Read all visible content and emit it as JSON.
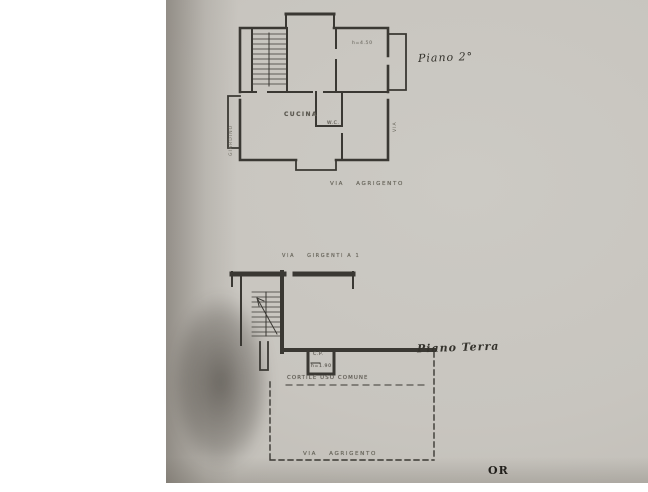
{
  "photo": {
    "paper_color": "#c8c5bf",
    "corner_mark": "OR"
  },
  "piano2": {
    "handwritten_label": "Piano 2°",
    "room_labels": {
      "kitchen": "CUCINA",
      "wc": "W.C.",
      "height_note": "h=4.50"
    },
    "side_label_left": "GIARDINO",
    "side_label_right": "VIA",
    "street_bottom": {
      "prefix": "VIA",
      "name": "AGRIGENTO"
    }
  },
  "piano_terra": {
    "handwritten_label": "Piano Terra",
    "street_top": {
      "prefix": "VIA",
      "name": "GIRGENTI A 1"
    },
    "small_room": {
      "line1": "C.P.",
      "line2": "h=1.90"
    },
    "courtyard_label": "CORTILE USO COMUNE",
    "street_bottom": {
      "prefix": "VIA",
      "name": "AGRIGENTO"
    }
  }
}
